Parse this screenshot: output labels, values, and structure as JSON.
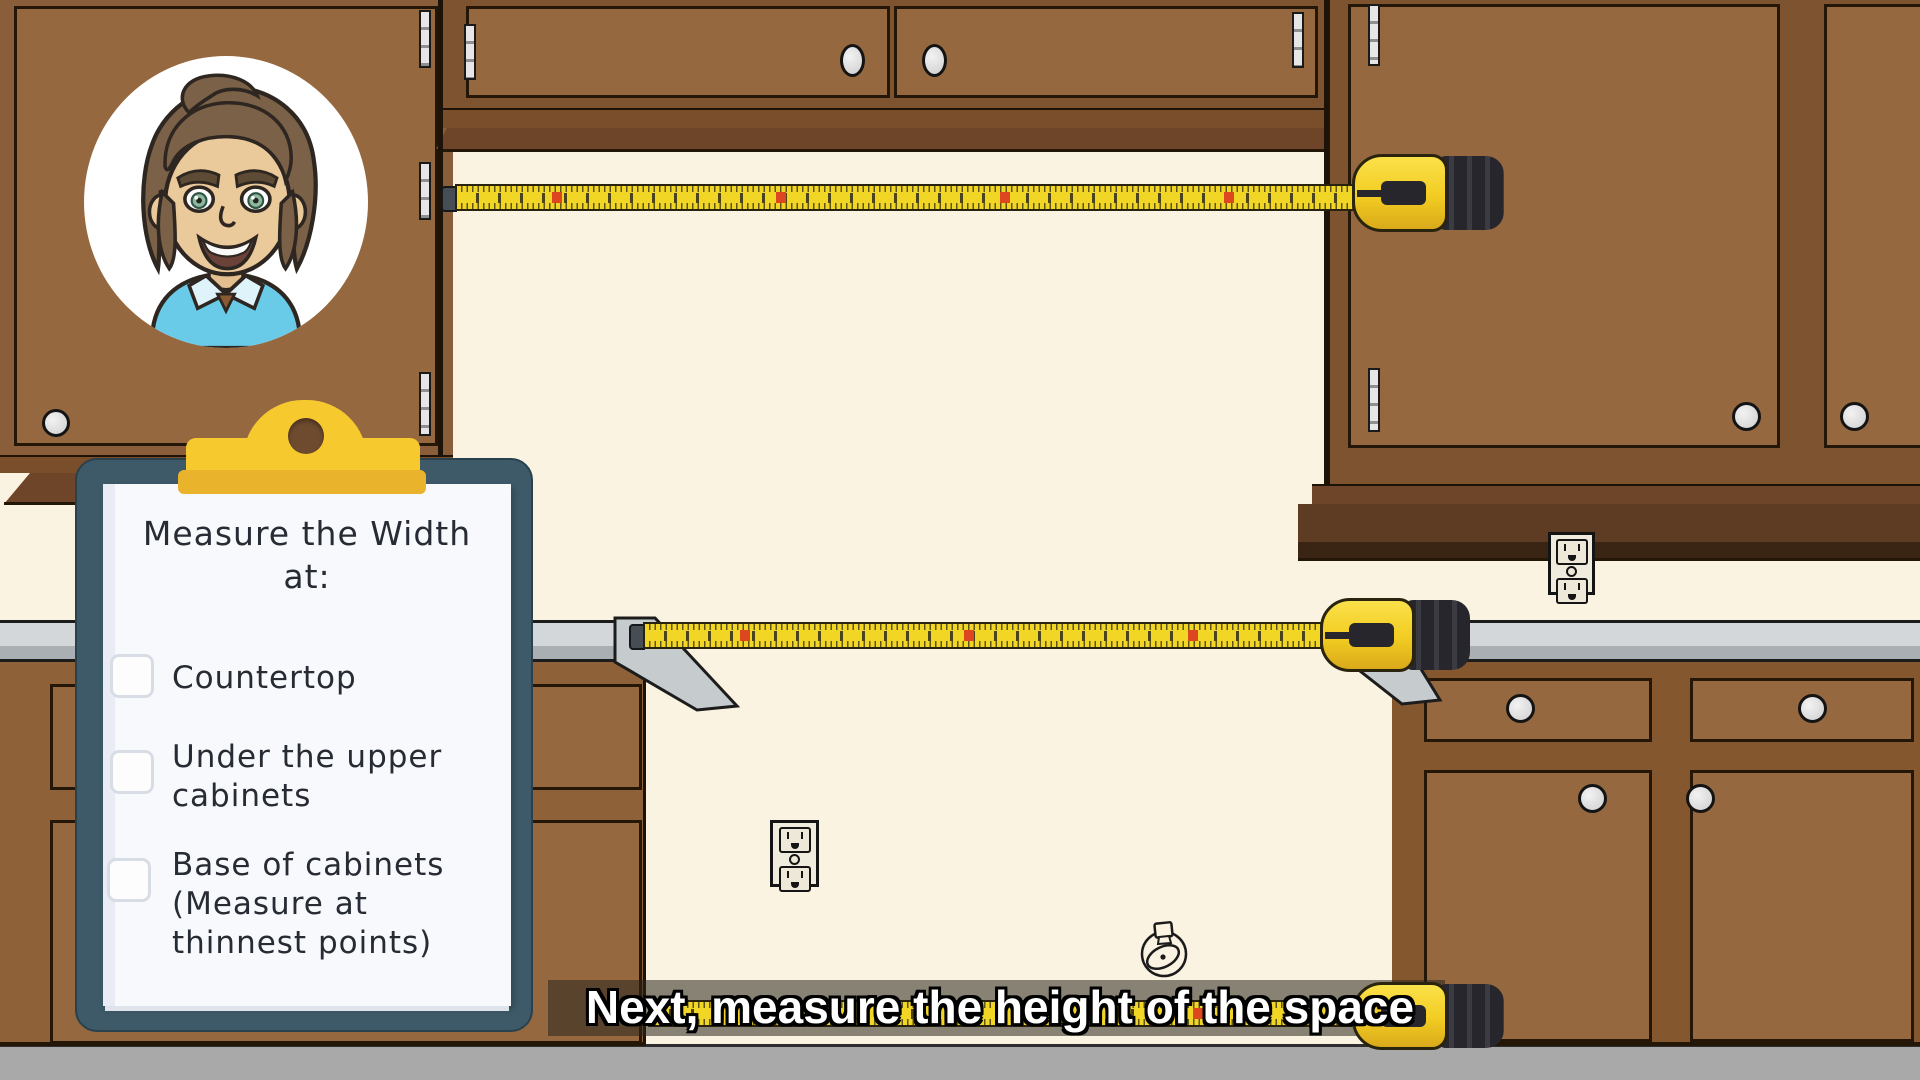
{
  "scene": {
    "description": "Cartoon kitchen tutorial frame: upper and lower brown cabinets, yellow tape measures spanning the open appliance space, presenter avatar, checklist clipboard and subtitle caption"
  },
  "clipboard": {
    "title_lines": [
      "Measure the Width",
      "at:"
    ],
    "items": [
      {
        "label": "Countertop",
        "checked": false,
        "lines": [
          "Countertop"
        ]
      },
      {
        "label": "Under the upper cabinets",
        "checked": false,
        "lines": [
          "Under the upper",
          "cabinets"
        ]
      },
      {
        "label": "Base of cabinets (Measure at thinnest points)",
        "checked": false,
        "lines": [
          "Base of cabinets",
          "(Measure at",
          "thinnest points)"
        ]
      }
    ]
  },
  "caption": {
    "text": "Next, measure the height of the space"
  },
  "icons": {
    "avatar": "presenter-avatar",
    "tape": "tape-measure-icon",
    "outlet": "wall-outlet-icon",
    "fixture": "gas-valve-line-icon"
  },
  "colors": {
    "wall": "#FBF3E1",
    "floor": "#A9A9A9",
    "cabinet_face": "#96683F",
    "cabinet_frame": "#7E5330",
    "cabinet_trim": "#6E4529",
    "counter_light": "#D3D7D9",
    "counter_edge": "#A9AFB2",
    "tape_yellow": "#F2D625",
    "tape_marker_red": "#DD4720",
    "clip_yellow": "#F6C92F",
    "clipboard_board": "#3E5A68",
    "paper_white": "#F8F9FC",
    "ink": "#262B34",
    "knob_gray": "#CFCFCF",
    "shirt_blue": "#6ACBE8",
    "hair_brown": "#7B6148",
    "skin": "#EAC99B"
  }
}
